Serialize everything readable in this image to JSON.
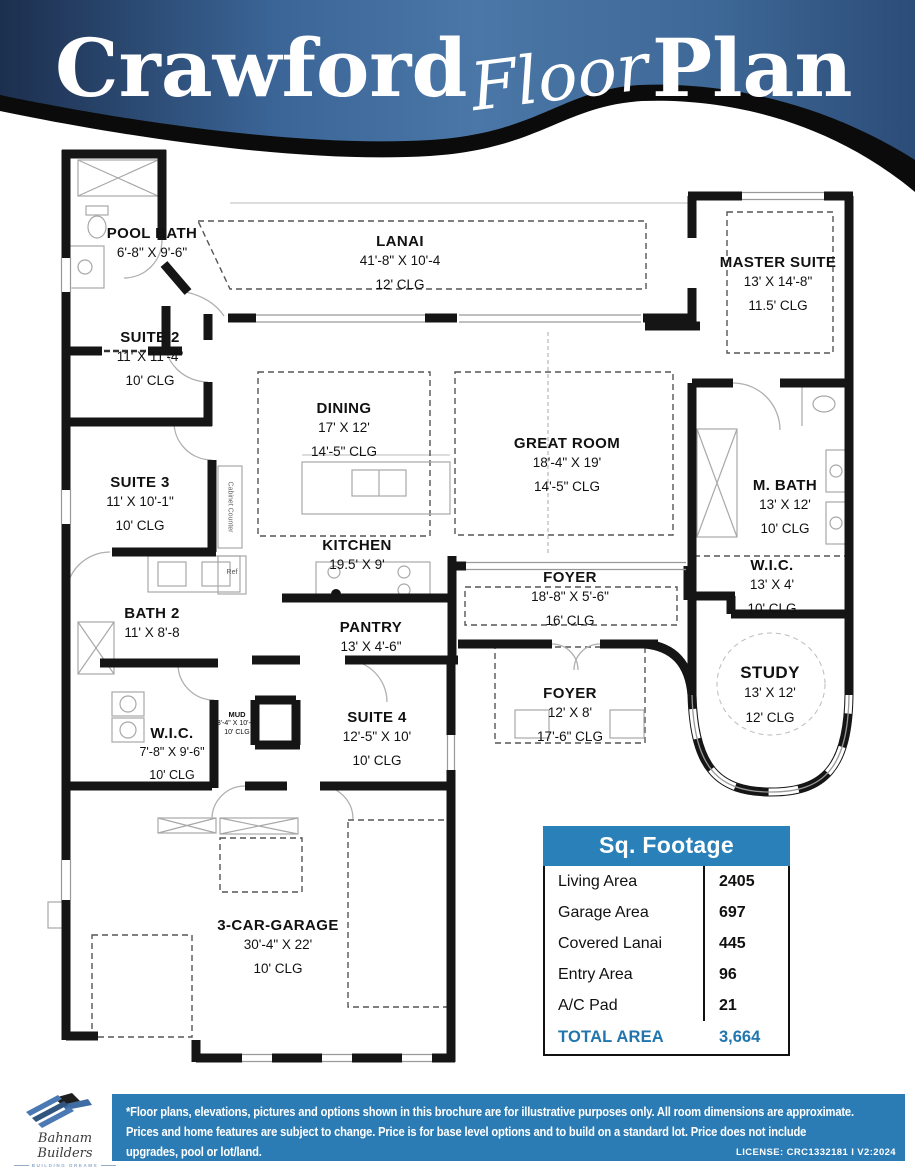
{
  "header": {
    "title_main": "Crawford",
    "title_script": "Floor",
    "title_end": "Plan"
  },
  "rooms": {
    "pool_bath": {
      "name": "POOL BATH",
      "dims": "6'-8\" X 9'-6\""
    },
    "lanai": {
      "name": "LANAI",
      "dims": "41'-8\" X 10'-4",
      "clg": "12' CLG"
    },
    "master_suite": {
      "name": "MASTER SUITE",
      "dims": "13' X 14'-8\"",
      "clg": "11.5' CLG"
    },
    "suite_2": {
      "name": "SUITE 2",
      "dims": "11' X 11'-4\"",
      "clg": "10' CLG"
    },
    "dining": {
      "name": "DINING",
      "dims": "17' X 12'",
      "clg": "14'-5\" CLG"
    },
    "great_room": {
      "name": "GREAT ROOM",
      "dims": "18'-4\" X 19'",
      "clg": "14'-5\" CLG"
    },
    "suite_3": {
      "name": "SUITE 3",
      "dims": "11' X 10'-1\"",
      "clg": "10' CLG"
    },
    "m_bath": {
      "name": "M. BATH",
      "dims": "13' X 12'",
      "clg": "10' CLG"
    },
    "kitchen": {
      "name": "KITCHEN",
      "dims": "19.5' X 9'"
    },
    "foyer_main": {
      "name": "FOYER",
      "dims": "18'-8\" X 5'-6\"",
      "clg": "16' CLG"
    },
    "wic_master": {
      "name": "W.I.C.",
      "dims": "13' X 4'",
      "clg": "10' CLG"
    },
    "bath_2": {
      "name": "BATH 2",
      "dims": "11' X 8'-8"
    },
    "pantry": {
      "name": "PANTRY",
      "dims": "13' X 4'-6\""
    },
    "study": {
      "name": "STUDY",
      "dims": "13' X 12'",
      "clg": "12' CLG"
    },
    "foyer_entry": {
      "name": "FOYER",
      "dims": "12' X 8'",
      "clg": "17'-6\" CLG"
    },
    "wic_2": {
      "name": "W.I.C.",
      "dims": "7'-8\" X 9'-6\"",
      "clg": "10' CLG"
    },
    "suite_4": {
      "name": "SUITE 4",
      "dims": "12'-5\" X 10'",
      "clg": "10' CLG"
    },
    "mud": {
      "name": "MUD",
      "dims": "3'-4\" X 10'-0\"",
      "clg": "10' CLG"
    },
    "garage": {
      "name": "3-CAR-GARAGE",
      "dims": "30'-4\" X 22'",
      "clg": "10' CLG"
    }
  },
  "annotations": {
    "cabinet_counter": "Cabinet Counter",
    "ref": "Ref"
  },
  "sq_footage": {
    "title": "Sq. Footage",
    "rows": [
      {
        "label": "Living Area",
        "value": "2405"
      },
      {
        "label": "Garage Area",
        "value": "697"
      },
      {
        "label": "Covered Lanai",
        "value": "445"
      },
      {
        "label": "Entry Area",
        "value": "96"
      },
      {
        "label": "A/C Pad",
        "value": "21"
      }
    ],
    "total": {
      "label": "TOTAL AREA",
      "value": "3,664"
    }
  },
  "footer": {
    "logo_name": "Bahnam Builders",
    "logo_tagline": "BUILDING DREAMS",
    "disclaimer_line1": "*Floor plans, elevations, pictures and options shown in this brochure are for illustrative purposes only. All room dimensions are approximate.",
    "disclaimer_line2": "Prices and home features are subject to change. Price is for base level options and to build on a standard lot.  Price does not include",
    "disclaimer_line3": "upgrades, pool or lot/land.",
    "license": "LICENSE: CRC1332181 I V2:2024"
  },
  "colors": {
    "banner_blue": "#3f6b9d",
    "table_header_blue": "#2a80b9",
    "footer_blue": "#2b7cb5",
    "total_blue": "#2176ae"
  }
}
